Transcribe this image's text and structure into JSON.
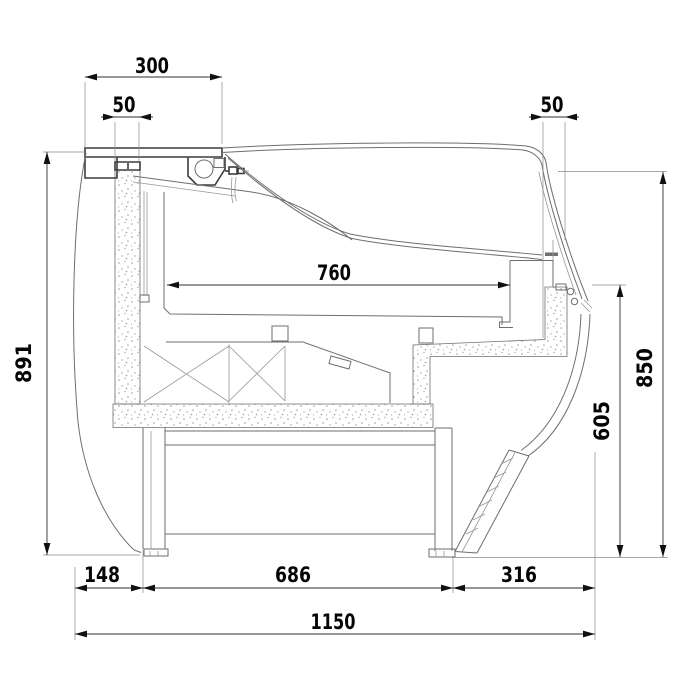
{
  "drawing": {
    "kind": "technical cross-section of refrigerated serve-over display counter",
    "dims": {
      "top_width": "300",
      "rear_wall_thickness": "50",
      "front_wall_thickness": "50",
      "display_depth": "760",
      "rear_height": "891",
      "front_height": "850",
      "glass_bottom_height": "605",
      "rear_overhang": "148",
      "base_span": "686",
      "front_overhang": "316",
      "total_depth": "1150"
    },
    "colors": {
      "background": "#ffffff",
      "drawing_lines": "#6e6e6e",
      "bold_lines": "#3c3c3c",
      "dimension_lines": "#2f2f2f",
      "dimension_text": "#050505",
      "speckle_dots": "#9c9c9c"
    }
  }
}
